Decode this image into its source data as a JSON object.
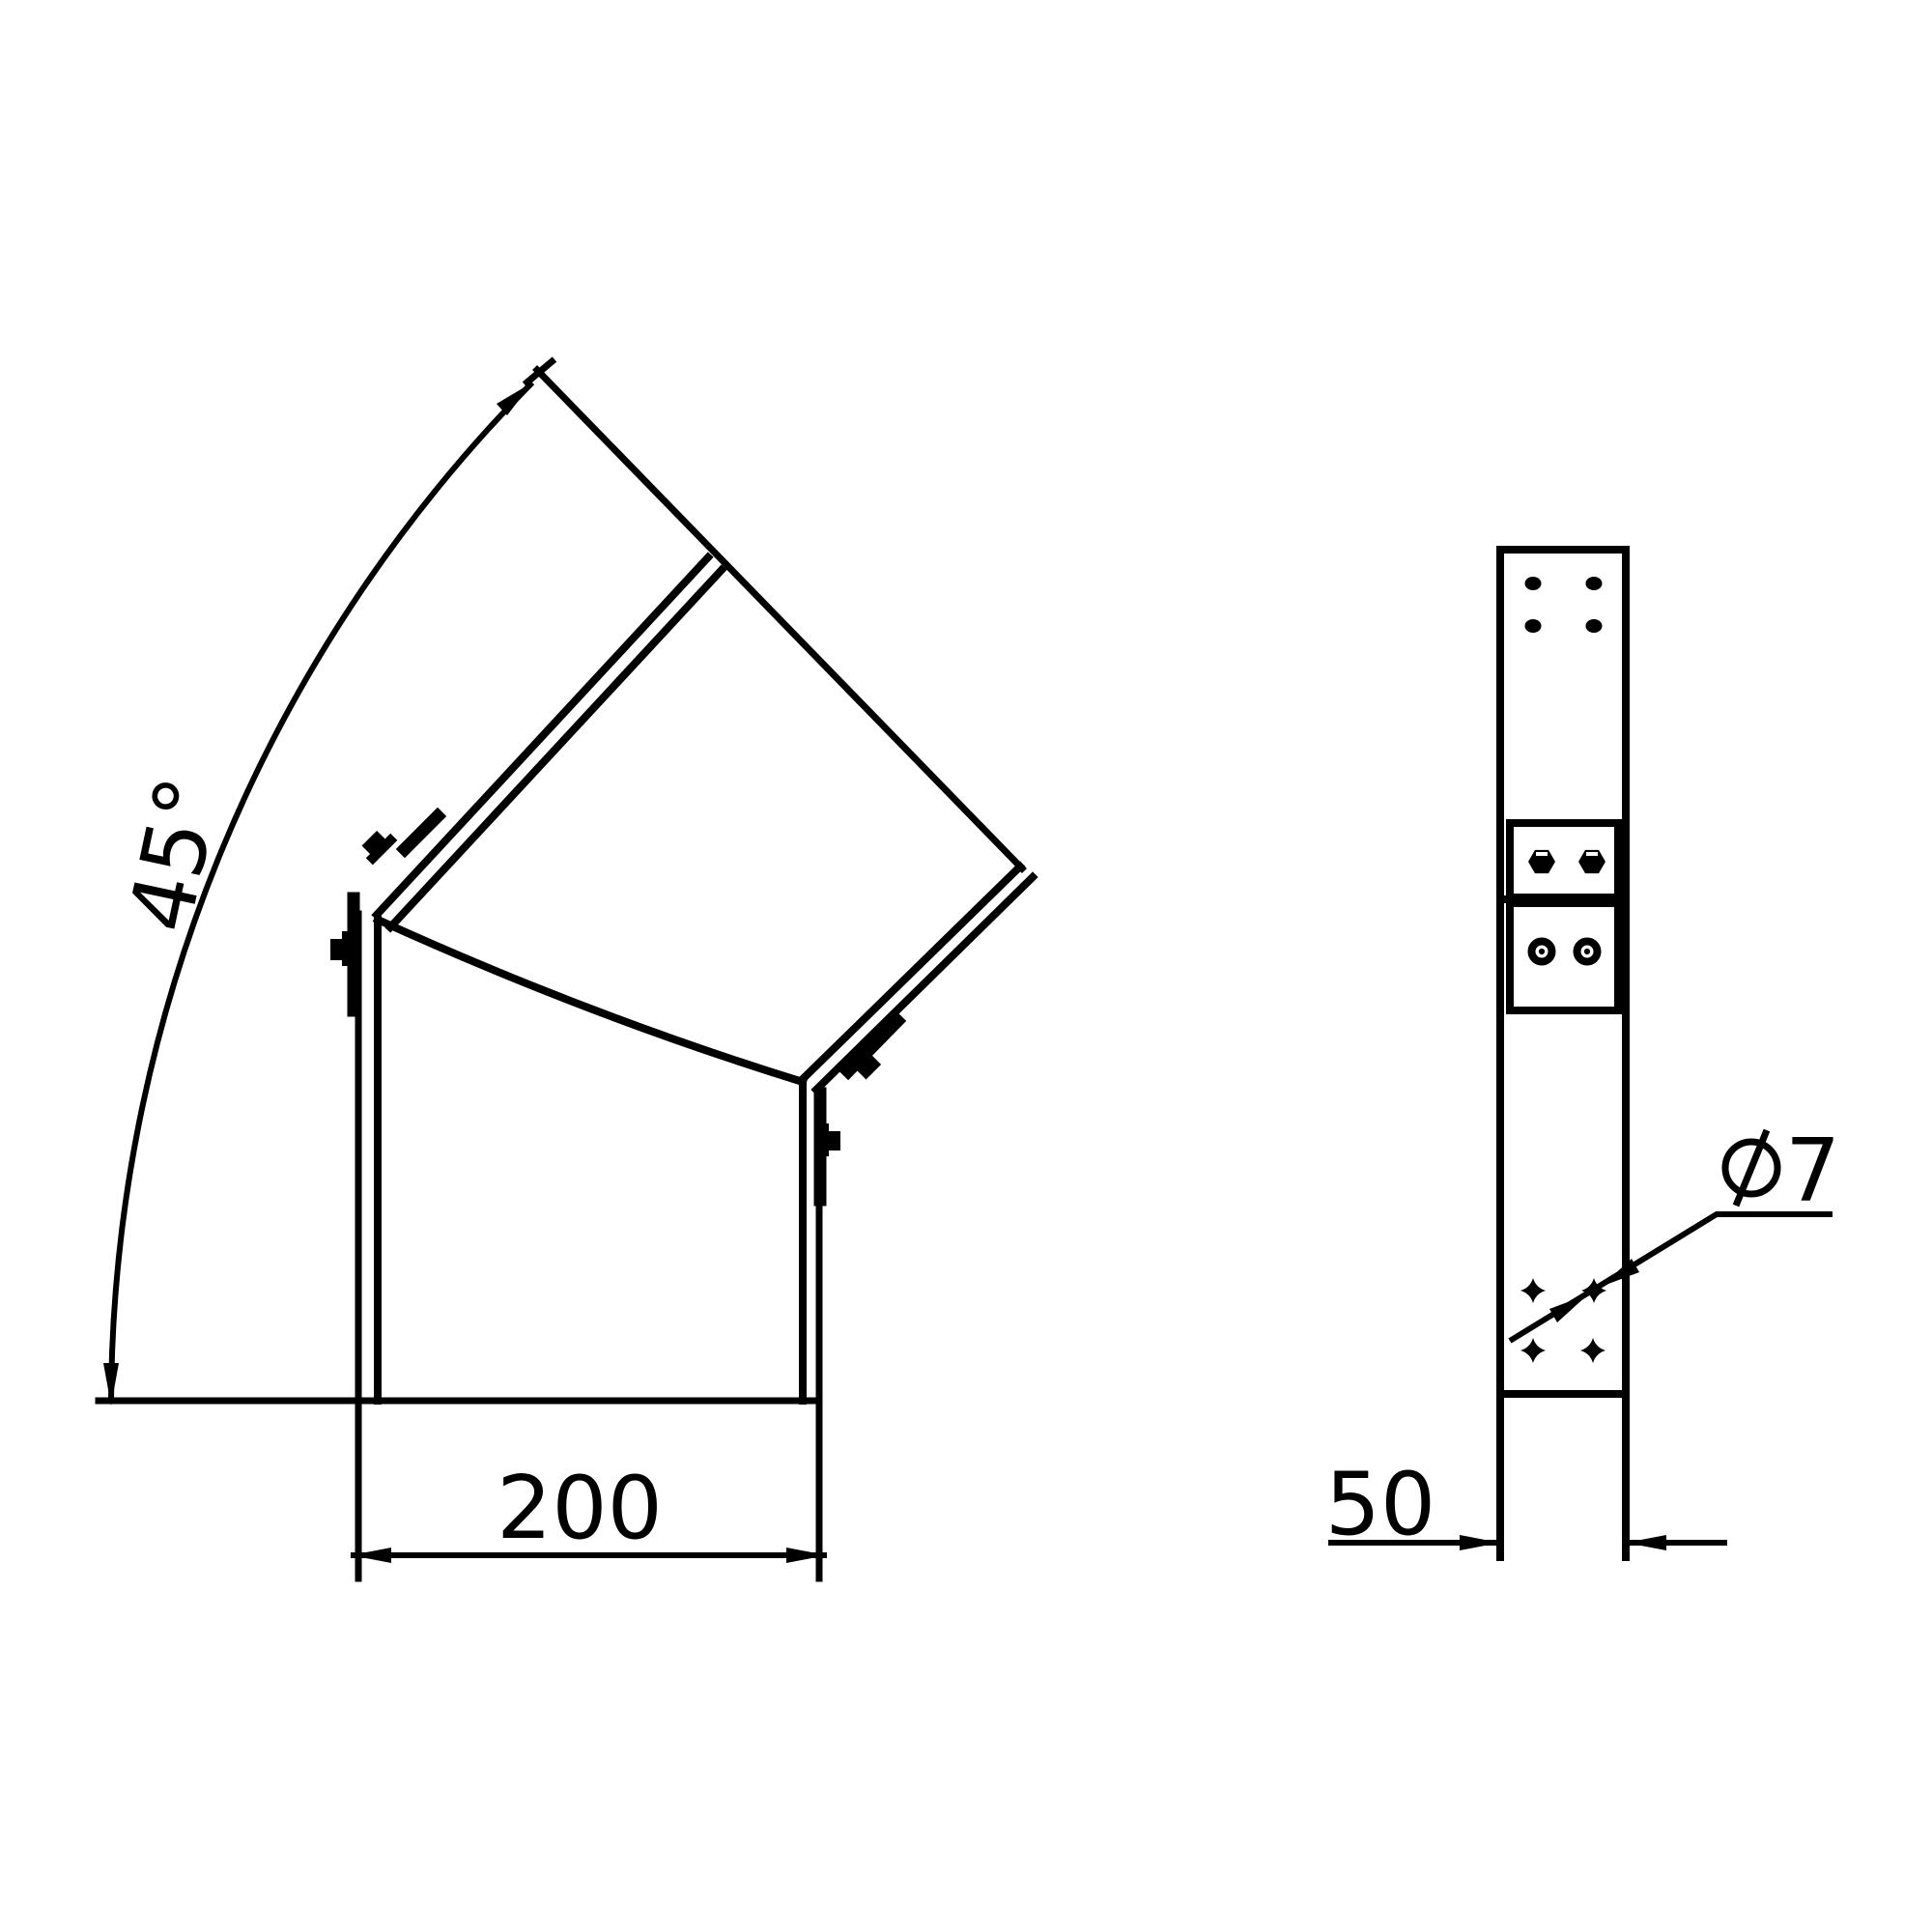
{
  "drawing": {
    "type": "technical-cad-drawing",
    "description": "45 degree elbow cover, pictorial view and side profile view",
    "background_color": "#ffffff",
    "line_color": "#000000",
    "dimensions": {
      "angle": {
        "label": "45°",
        "value": 45,
        "unit": "deg"
      },
      "width": {
        "label": "200",
        "value": 200
      },
      "depth": {
        "label": "50",
        "value": 50
      },
      "hole": {
        "label": "Ø7",
        "digit": "7",
        "diameter": 7
      }
    },
    "views": {
      "pictorial": {
        "name": "angled pictorial view of 45° bend section"
      },
      "profile": {
        "name": "side profile view with bolt clamp and holes"
      }
    }
  }
}
